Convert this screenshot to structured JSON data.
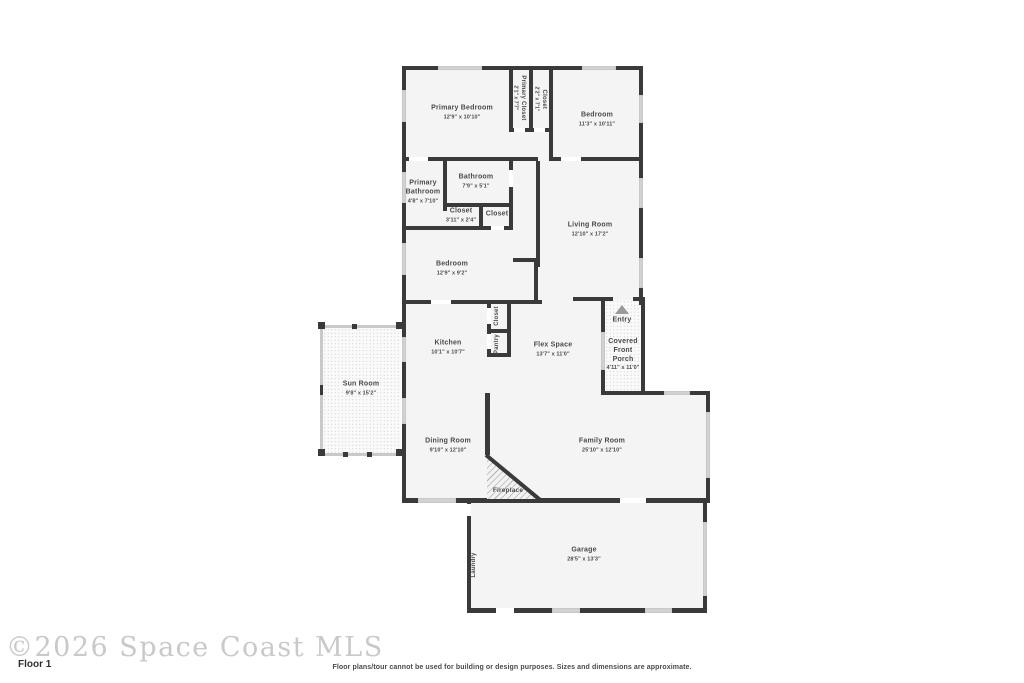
{
  "meta": {
    "watermark": "©2026 Space Coast MLS",
    "floor_label": "Floor 1",
    "disclaimer": "Floor plans/tour cannot be used for building or design purposes. Sizes and dimensions are approximate."
  },
  "colors": {
    "wall": "#3a3a3a",
    "room_fill": "#f4f4f4",
    "window": "#d2d2d2",
    "label_text": "#4a4a4a",
    "watermark_text": "#c9c9c9",
    "entry_arrow": "#9a9a9a"
  },
  "rooms": [
    {
      "id": "primary-bedroom",
      "name": "Primary Bedroom",
      "dims": "12'9\" x 10'10\""
    },
    {
      "id": "primary-closet",
      "name": "Primary Closet",
      "dims": "2'1\" x 7'7\""
    },
    {
      "id": "closet-top",
      "name": "Closet",
      "dims": "2'2\" x 7'1\""
    },
    {
      "id": "bedroom-front",
      "name": "Bedroom",
      "dims": "11'3\" x 10'11\""
    },
    {
      "id": "primary-bathroom",
      "name": "Primary Bathroom",
      "dims": "4'8\" x 7'10\""
    },
    {
      "id": "bathroom",
      "name": "Bathroom",
      "dims": "7'9\" x 5'1\""
    },
    {
      "id": "closet-hall",
      "name": "Closet",
      "dims": "3'11\" x 2'4\""
    },
    {
      "id": "closet-hall-2",
      "name": "Closet",
      "dims": ""
    },
    {
      "id": "living-room",
      "name": "Living Room",
      "dims": "12'10\" x 17'2\""
    },
    {
      "id": "bedroom-middle",
      "name": "Bedroom",
      "dims": "12'9\" x 9'2\""
    },
    {
      "id": "sun-room",
      "name": "Sun Room",
      "dims": "9'8\" x 15'2\""
    },
    {
      "id": "kitchen",
      "name": "Kitchen",
      "dims": "10'1\" x 10'7\""
    },
    {
      "id": "closet-pantry",
      "name": "Closet",
      "dims": ""
    },
    {
      "id": "pantry",
      "name": "Pantry",
      "dims": ""
    },
    {
      "id": "flex-space",
      "name": "Flex Space",
      "dims": "13'7\" x 11'0\""
    },
    {
      "id": "entry",
      "name": "Entry",
      "dims": ""
    },
    {
      "id": "covered-porch",
      "name": "Covered Front Porch",
      "dims": "4'11\" x 11'0\""
    },
    {
      "id": "dining-room",
      "name": "Dining Room",
      "dims": "9'10\" x 12'10\""
    },
    {
      "id": "family-room",
      "name": "Family Room",
      "dims": "25'10\" x 12'10\""
    },
    {
      "id": "fireplace",
      "name": "Fireplace",
      "dims": ""
    },
    {
      "id": "garage",
      "name": "Garage",
      "dims": "28'5\" x 13'3\""
    },
    {
      "id": "laundry",
      "name": "Laundry",
      "dims": ""
    }
  ]
}
